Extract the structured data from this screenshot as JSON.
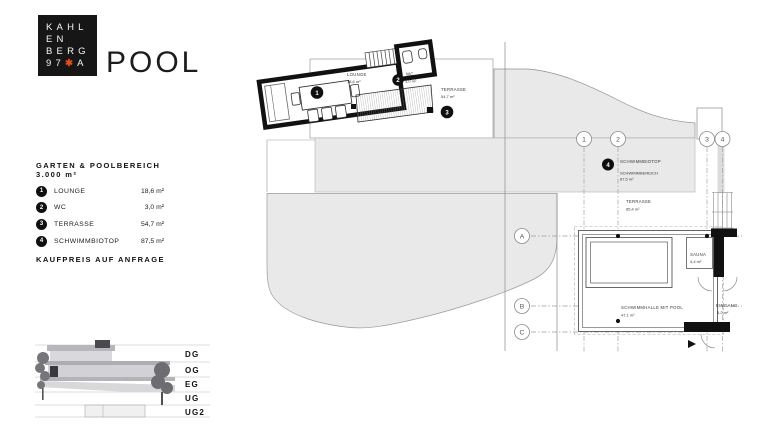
{
  "brand": {
    "logo": {
      "line1": "KAHL",
      "line2": "EN",
      "line3": "BERG",
      "line4_digits": "97",
      "line4_star": "✱",
      "line4_letter": "A"
    },
    "title": "POOL"
  },
  "panel": {
    "heading": "GARTEN & POOLBEREICH",
    "subheading": "3.000 m²",
    "items": [
      {
        "num": "1",
        "label": "LOUNGE",
        "value": "18,6 m²"
      },
      {
        "num": "2",
        "label": "WC",
        "value": "3,0 m²"
      },
      {
        "num": "3",
        "label": "TERRASSE",
        "value": "54,7 m²"
      },
      {
        "num": "4",
        "label": "SCHWIMMBIOTOP",
        "value": "87,5 m²"
      }
    ],
    "price_note": "KAUFPREIS AUF ANFRAGE"
  },
  "section": {
    "floors": [
      "DG",
      "OG",
      "EG",
      "UG",
      "UG2"
    ]
  },
  "plan": {
    "grid": {
      "cols": [
        "1",
        "2",
        "3",
        "4"
      ],
      "rows": [
        "A",
        "B",
        "C"
      ]
    },
    "labels": {
      "lounge": {
        "marker": "1",
        "name": "LOUNGE",
        "area": "18,6 m²"
      },
      "wc": {
        "marker": "2",
        "name": "WC",
        "area": "3,0 m²"
      },
      "terrace_upper": {
        "marker": "3",
        "name": "TERRASSE",
        "area": "54,7 m²"
      },
      "biotop": {
        "marker": "4",
        "name": "SCHWIMMBIOTOP",
        "sub": "SCHWIMMBEREICH",
        "area": "87,5 m²"
      },
      "terrace_lower": {
        "name": "TERRASSE",
        "area": "85,4 m²"
      },
      "pool_hall": {
        "name": "SCHWIMMHALLE MIT POOL",
        "area": "47,1 m²"
      },
      "sauna": {
        "name": "SAUNA",
        "area": "4,4 m²"
      },
      "entrance": {
        "name": "EINGANG",
        "area": "5,2 m²"
      }
    }
  },
  "colors": {
    "accent": "#e84b1c",
    "plan_fill": "#e9e9e9",
    "ink": "#111111"
  }
}
